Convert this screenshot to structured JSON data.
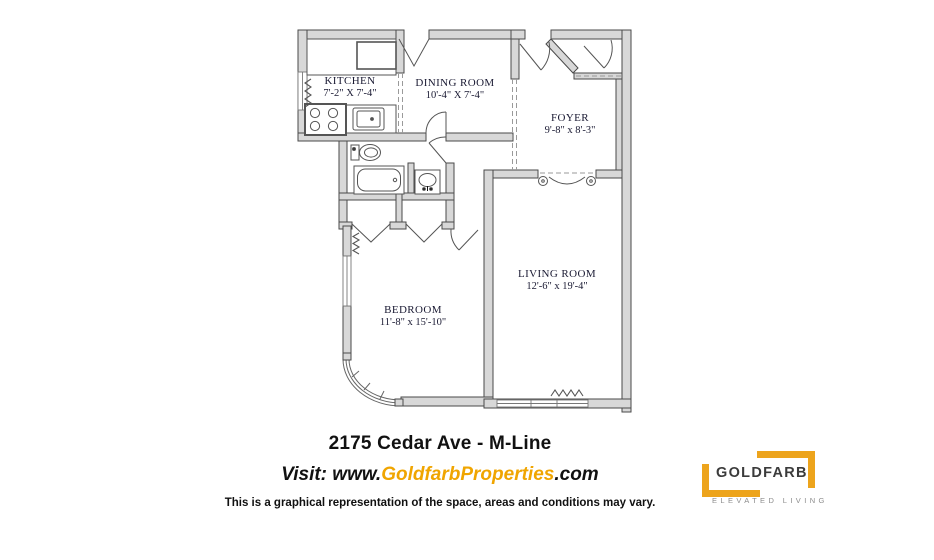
{
  "plan": {
    "rooms": [
      {
        "id": "kitchen",
        "name": "KITCHEN",
        "dims": "7'-2\" X 7'-4\""
      },
      {
        "id": "dining-room",
        "name": "DINING ROOM",
        "dims": "10'-4\" X 7'-4\""
      },
      {
        "id": "foyer",
        "name": "FOYER",
        "dims": "9'-8\" x 8'-3\""
      },
      {
        "id": "living-room",
        "name": "LIVING ROOM",
        "dims": "12'-6\" x 19'-4\""
      },
      {
        "id": "bedroom",
        "name": "BEDROOM",
        "dims": "11'-8\" x 15'-10\""
      }
    ],
    "fixture_icons": [
      "stove-icon",
      "kitchen-sink-icon",
      "toilet-icon",
      "bathtub-icon",
      "vanity-sink-icon",
      "radiator-icon",
      "window",
      "door-swing",
      "closet-door",
      "french-door-scroll"
    ]
  },
  "footer": {
    "title": "2175 Cedar Ave - M-Line",
    "visit_prefix": "Visit: www.",
    "visit_brand": "GoldfarbProperties",
    "visit_suffix": ".com",
    "disclaimer": "This is a graphical representation of the space, areas and conditions may vary."
  },
  "logo": {
    "name": "GOLDFARB",
    "tagline": "ELEVATED LIVING"
  },
  "colors": {
    "wall_fill": "#D8D8D8",
    "wall_stroke": "#4A4A4A",
    "room_label": "#1A1A33",
    "brand_gold": "#F0A500",
    "logo_gold": "#EDA41C",
    "logo_text": "#3B3B3B",
    "tagline_gray": "#8C8C8C"
  }
}
